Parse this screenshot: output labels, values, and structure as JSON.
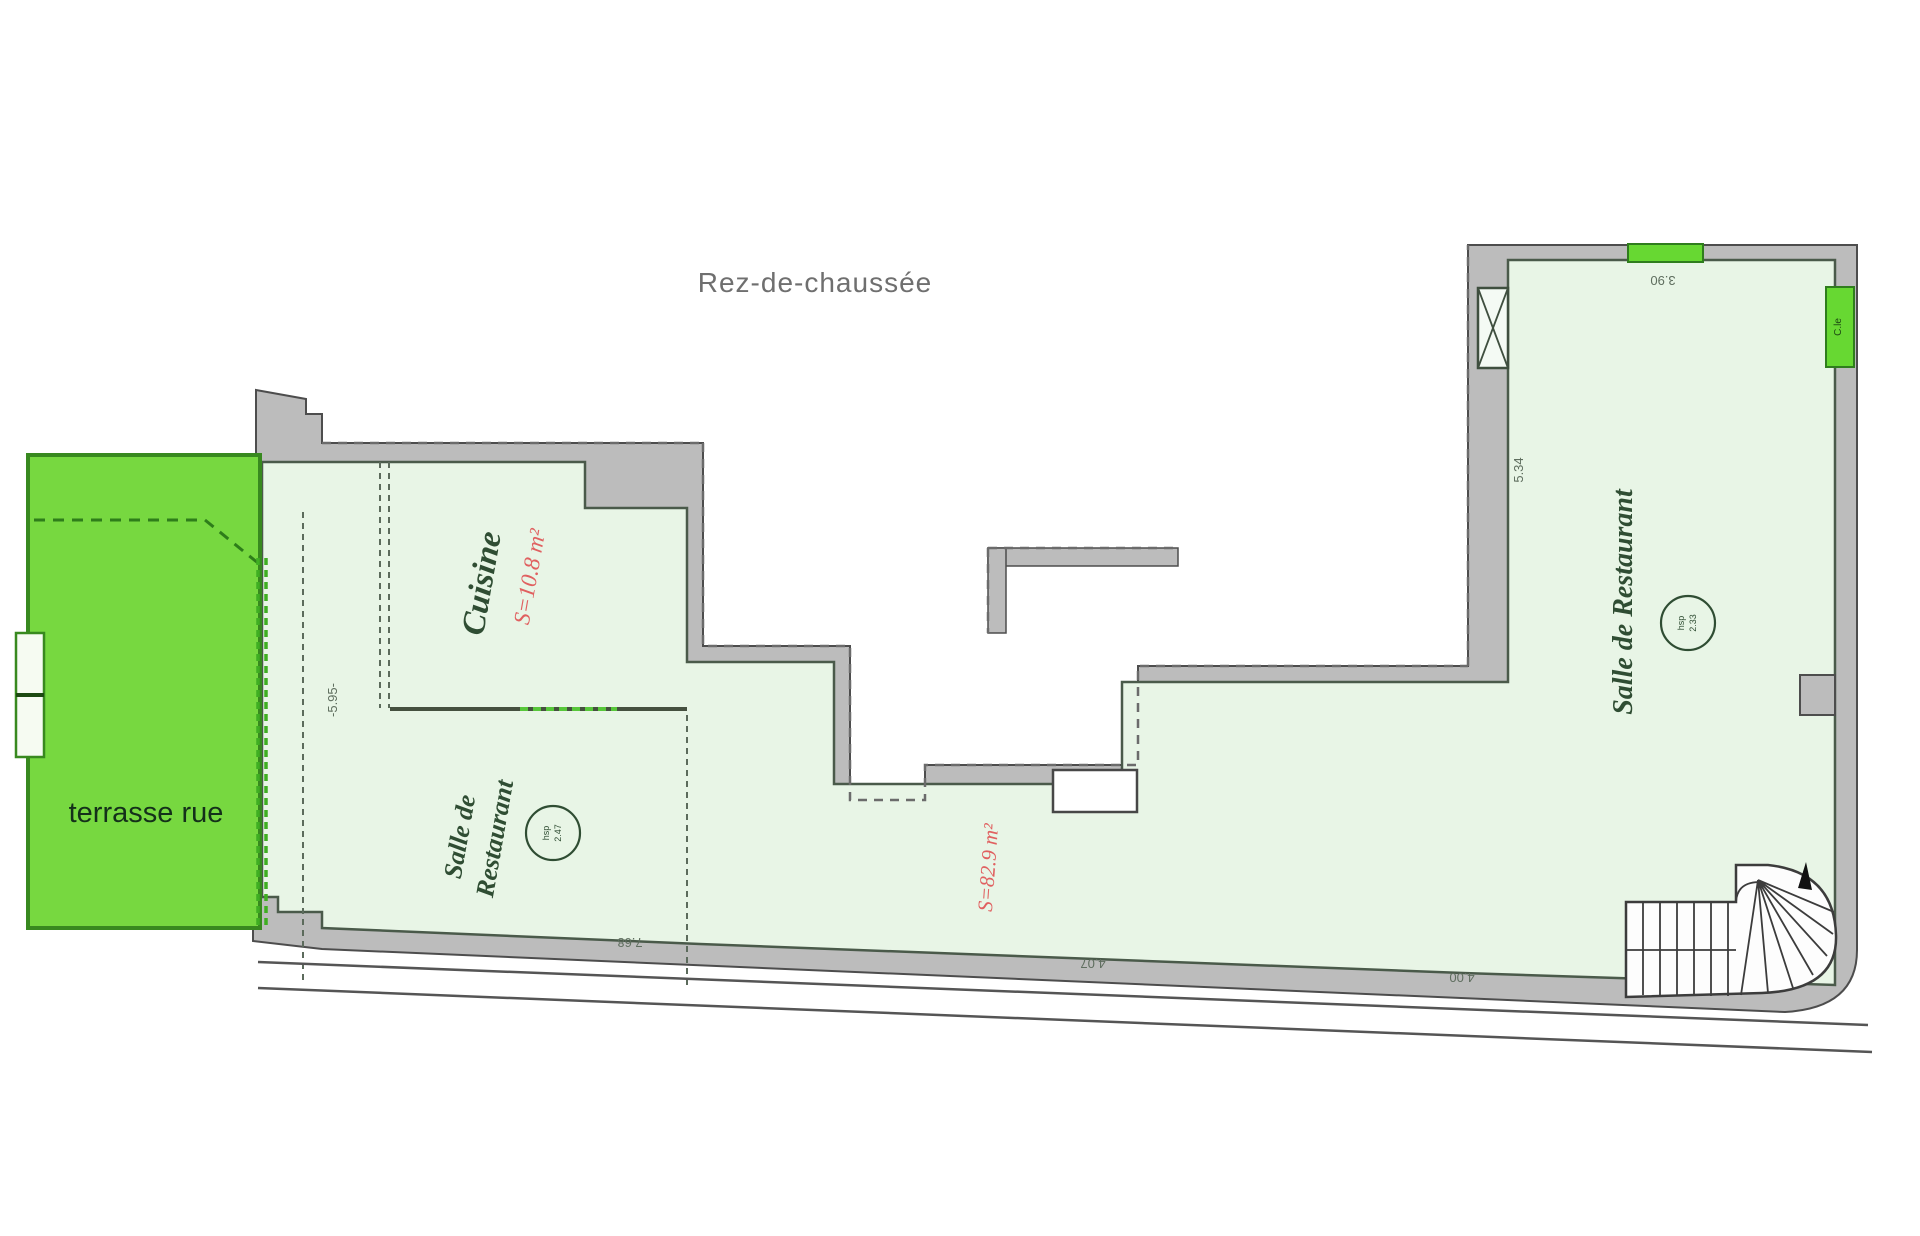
{
  "page": {
    "title": "Rez-de-chaussée"
  },
  "terrace": {
    "label": "terrasse rue",
    "fill": "#77d840",
    "border": "#38891f"
  },
  "rooms": {
    "cuisine": {
      "name": "Cuisine",
      "area": "S=10.8 m²"
    },
    "salle_left": {
      "name_line1": "Salle de",
      "name_line2": "Restaurant",
      "ceiling_label": "hsp",
      "ceiling_height": "2.47"
    },
    "salle_main": {
      "area": "S=82.9 m²"
    },
    "salle_right": {
      "name": "Salle de Restaurant",
      "ceiling_label": "hsp",
      "ceiling_height": "2.33"
    },
    "door_right": {
      "label": "C.le"
    }
  },
  "dimensions": {
    "right_wall": "5.34",
    "top_right": "3.90",
    "bottom_left": "7.68",
    "bottom_middle": "4.07",
    "bottom_right": "4.00",
    "left_interior": "-5.95-"
  },
  "colors": {
    "wall_gray": "#bcbcbc",
    "wall_edge": "#4d4d4d",
    "interior_green": "#e8f5e6",
    "interior_edge": "#4a5a4a",
    "terrace_green": "#77d840",
    "door_green": "#67d832",
    "area_red": "#e06060",
    "label_green": "#2f4d33"
  }
}
